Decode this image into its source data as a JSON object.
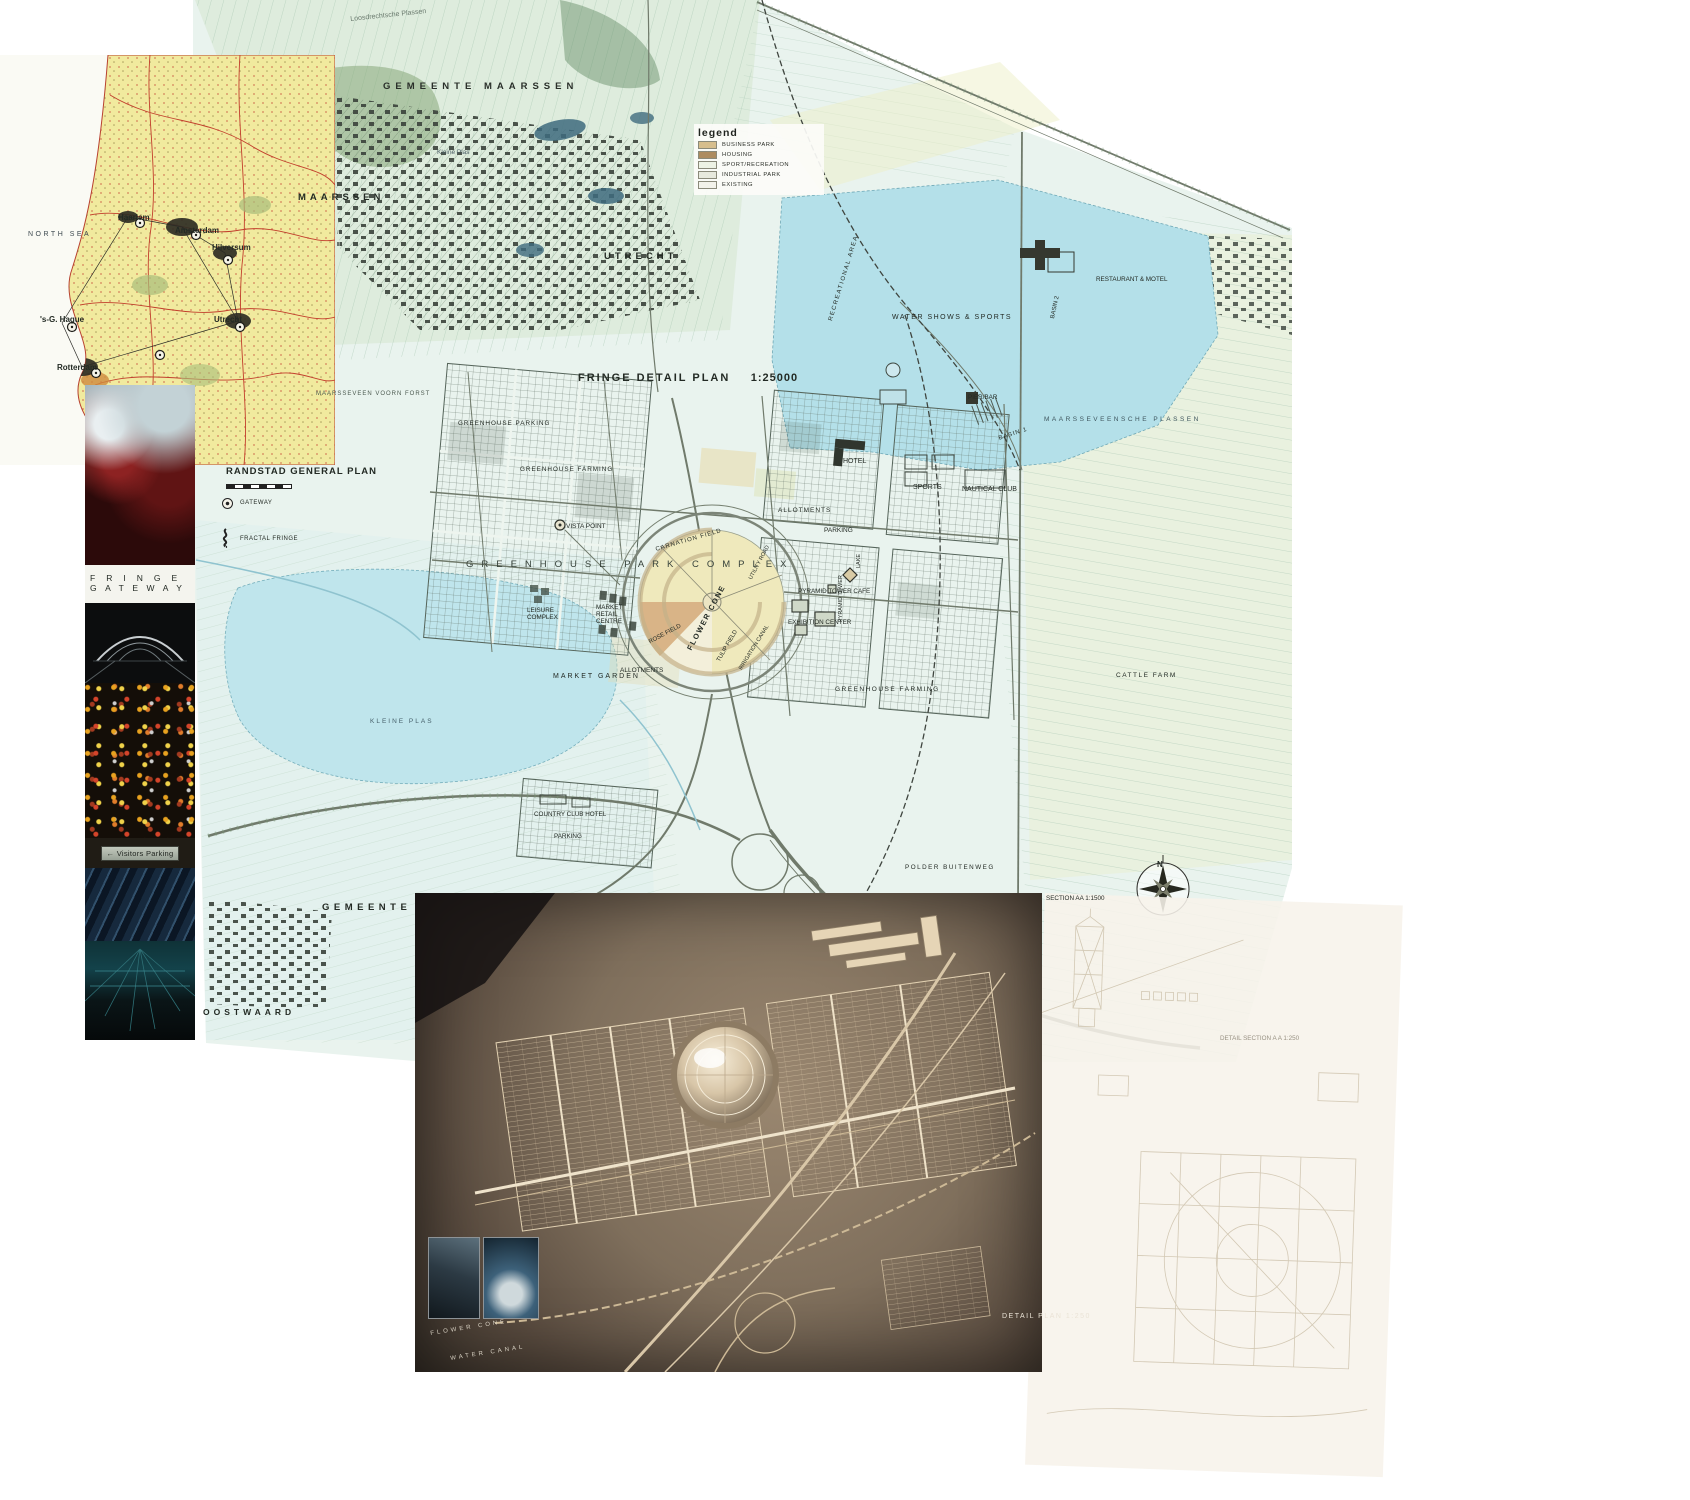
{
  "inset_map": {
    "title": "RANDSTAD GENERAL PLAN",
    "legend": {
      "gateway": "GATEWAY",
      "fractal_fringe": "FRACTAL FRINGE"
    },
    "labels": {
      "north_sea": "NORTH SEA",
      "haarlem": "Haarlem",
      "amsterdam": "Amsterdam",
      "hilversum": "Hilversum",
      "utrecht": "Utrecht",
      "den_haag": "'s-G. Hague",
      "rotterdam": "Rotterdam"
    }
  },
  "photo_strip": {
    "caption": {
      "line1": "FRINGE",
      "line2": "GATEWAY"
    },
    "sign": {
      "arrow": "←",
      "text": "Visitors Parking"
    }
  },
  "main_map": {
    "title": "FRINGE DETAIL PLAN",
    "scale": "1:25000",
    "compass_n": "N",
    "legend": {
      "title": "legend",
      "items": [
        {
          "label": "BUSINESS PARK",
          "color": "#d6be8d"
        },
        {
          "label": "HOUSING",
          "color": "#ad8c60"
        },
        {
          "label": "SPORT/RECREATION",
          "color": "#edf2e4"
        },
        {
          "label": "INDUSTRIAL PARK",
          "color": "#e7e9dd"
        },
        {
          "label": "EXISTING",
          "color": "#f2f2ea"
        }
      ]
    },
    "labels": {
      "gemeente_maarssen": "GEMEENTE MAARSSEN",
      "maarssen": "MAARSSEN",
      "utrecht": "UTRECHT",
      "loosdrecht": "Loosdrechtsche Plassen",
      "kleine_plas_top": "Kleine Plas",
      "water_shows": "WATER SHOWS & SPORTS",
      "restaurant_motel": "RESTAURANT & MOTEL",
      "recreational_area": "RECREATIONAL AREA",
      "basin_1": "BASIN 1",
      "basin_2": "BASIN 2",
      "pier_bar": "PIER/BAR",
      "maarsseveensche_plassen": "MAARSSEVEENSCHE PLASSEN",
      "hotel": "HOTEL",
      "sports": "SPORTS",
      "nautical_club": "NAUTICAL CLUB",
      "allotments_a": "ALLOTMENTS",
      "allotments_b": "ALLOTMENTS",
      "parking_a": "PARKING",
      "parking_b": "PARKING",
      "vista_point": "VISTA POINT",
      "greenhouse_parking": "GREENHOUSE PARKING",
      "greenhouse_farming_a": "GREENHOUSE FARMING",
      "greenhouse_farming_b": "GREENHOUSE FARMING",
      "park_complex": "GREENHOUSE PARK COMPLEX",
      "carnation_field": "CARNATION FIELD",
      "utility_road": "UTILITY ROAD",
      "flower_cone": "FLOWER CONE",
      "rose_field": "ROSE FIELD",
      "tulip_field": "TULIP FIELD",
      "irrigation_canal": "IRRIGATION CANAL",
      "leisure_complex": "LEISURE COMPLEX",
      "market_retail_centre": "MARKET RETAIL CENTRE",
      "market_garden": "MARKET GARDEN",
      "pyramid_tower": "PYRAMID TOWER",
      "lake": "LAKE",
      "pyramid_tower_cafe": "PYRAMID TOWER CAFE",
      "exhibition_center": "EXHIBITION CENTER",
      "cattle_farm": "CATTLE FARM",
      "kleine_plas": "KLEINE PLAS",
      "country_club_hotel": "COUNTRY CLUB HOTEL",
      "polder_buitenweg": "POLDER BUITENWEG",
      "maarsseveen_forest": "MAARSSEVEEN VOORN FORST",
      "gemeente_2": "GEMEENTE",
      "oostwaard": "OOSTWAARD"
    }
  },
  "model_photo": {
    "caption": "DETAIL PLAN 1:250",
    "labels": {
      "flower_cone": "FLOWER CONE",
      "water_canal": "WATER CANAL"
    }
  },
  "section_drawing": {
    "labels": {
      "section_aa": "SECTION AA 1:1500",
      "detail_section": "DETAIL SECTION A A 1:250"
    }
  }
}
